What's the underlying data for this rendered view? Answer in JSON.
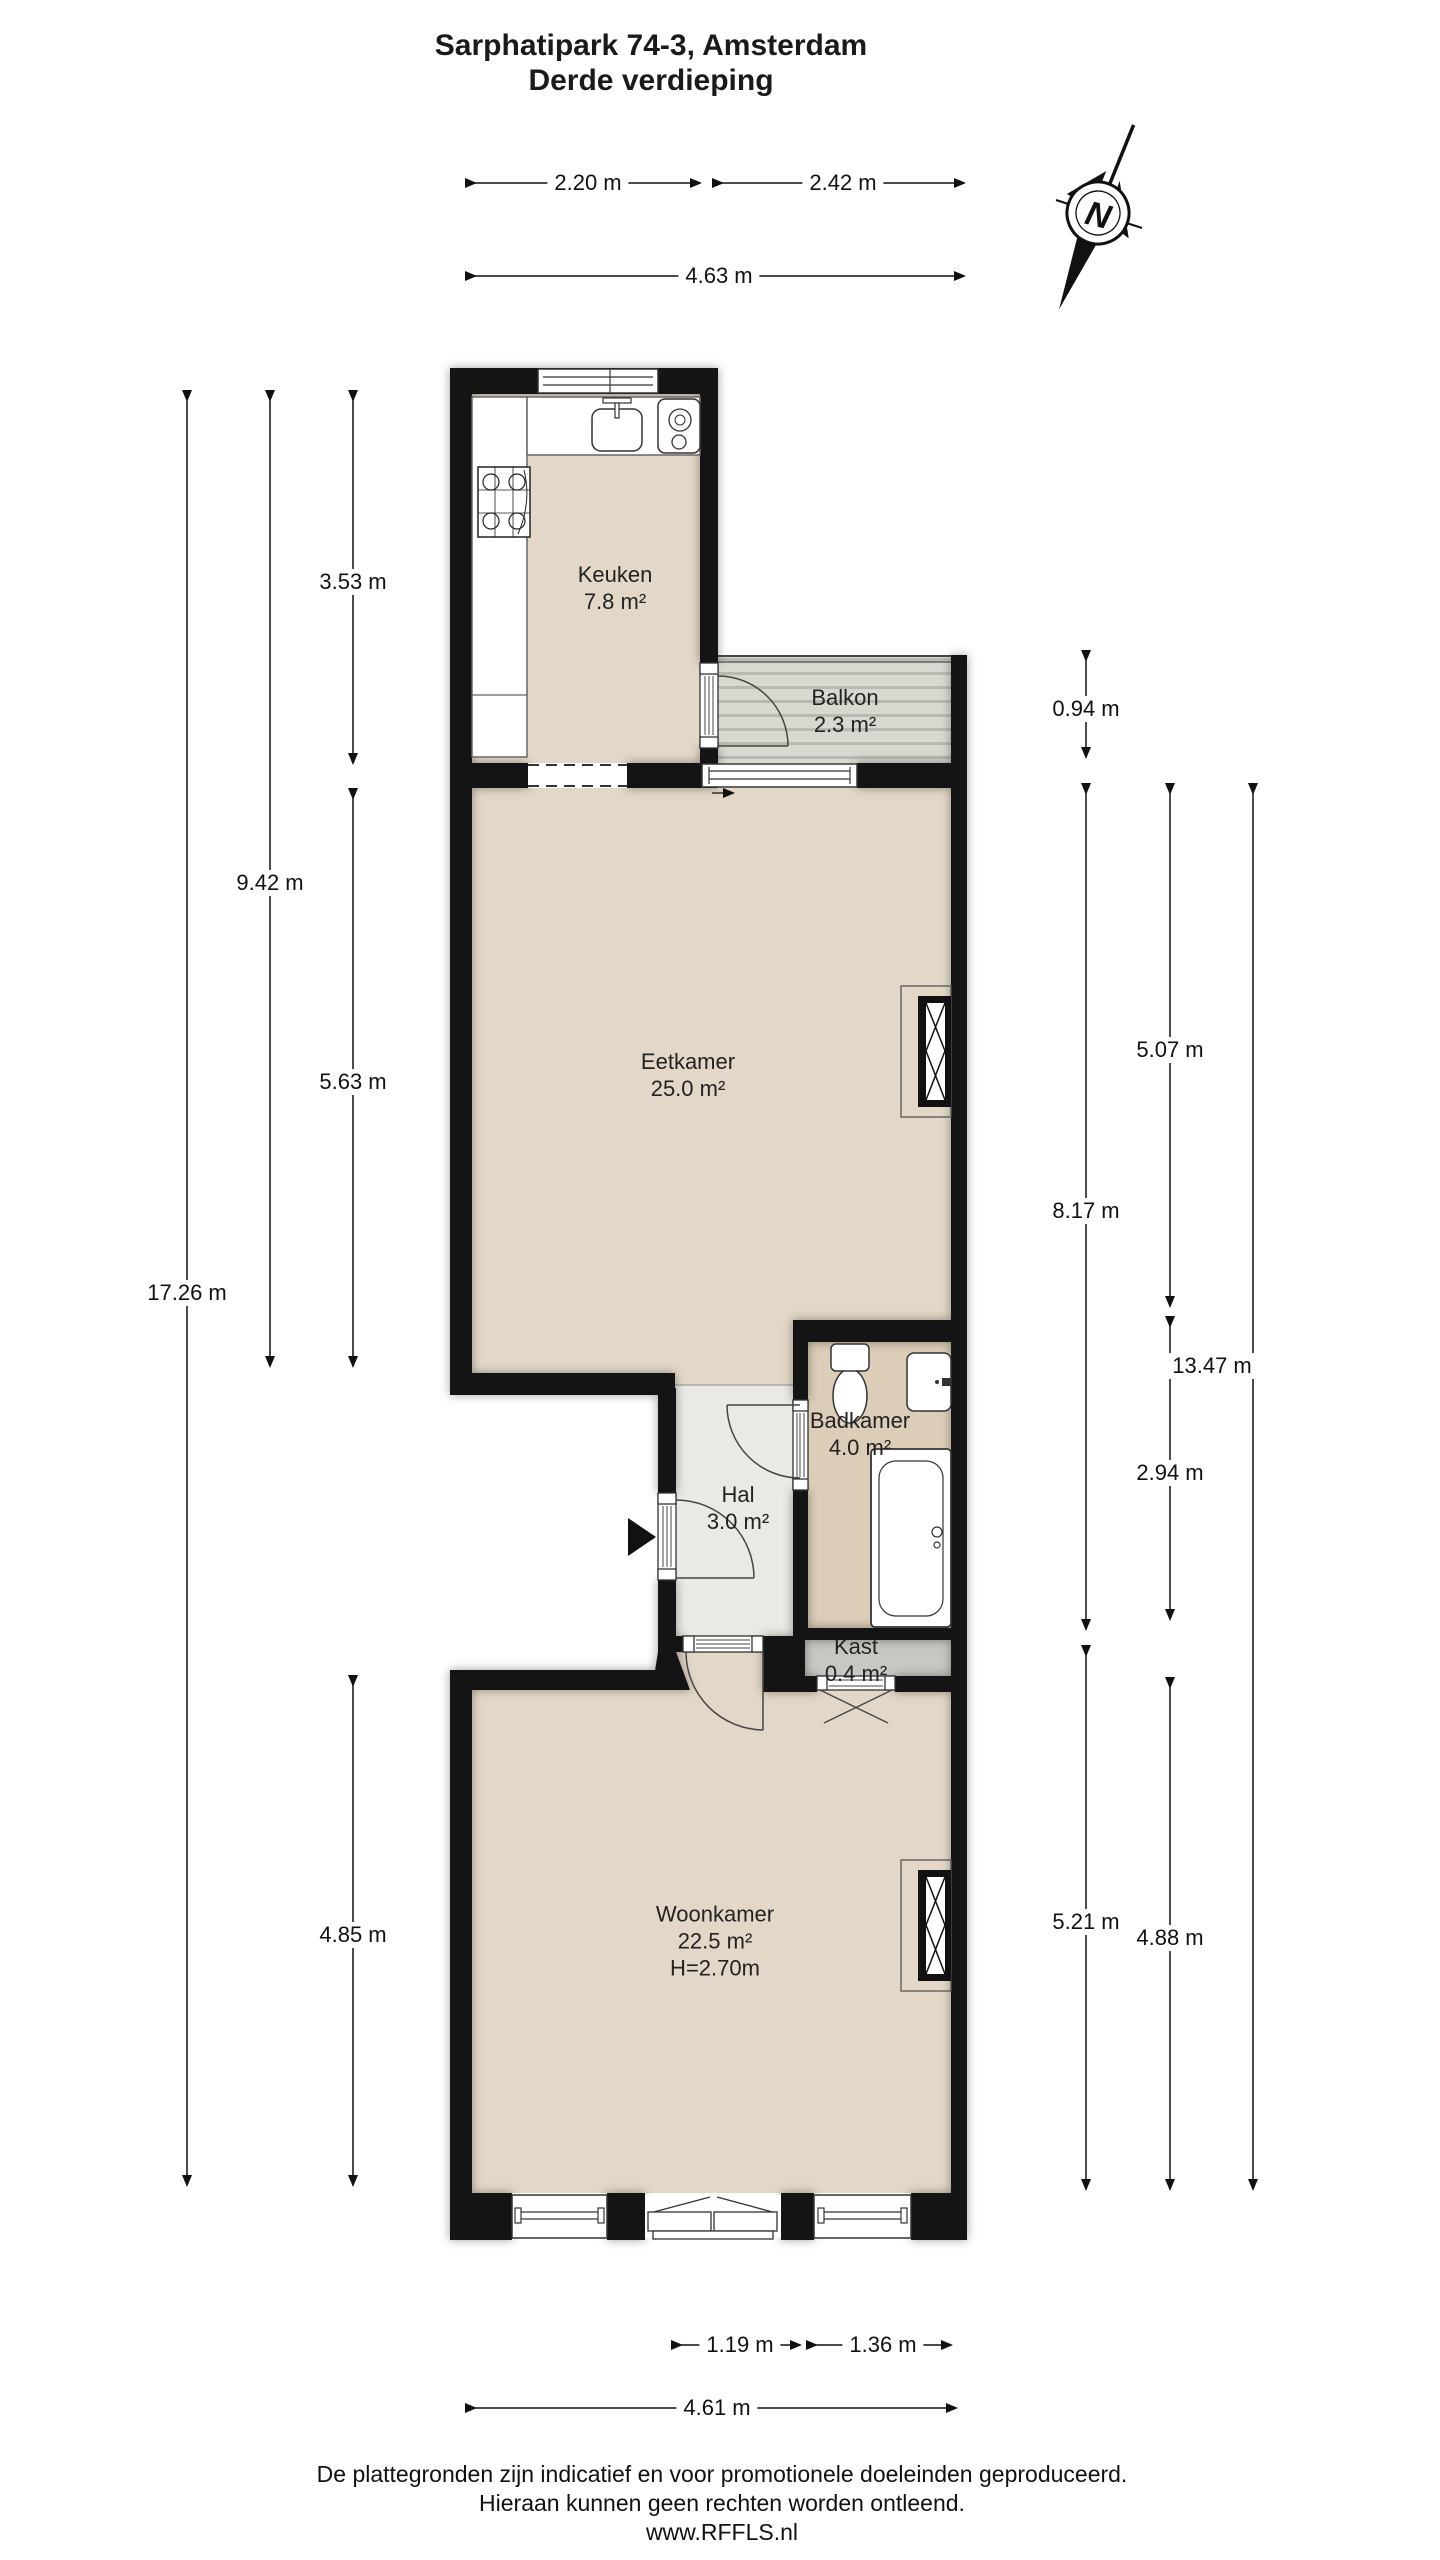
{
  "title": {
    "line1": "Sarphatipark 74-3, Amsterdam",
    "line2": "Derde verdieping"
  },
  "compass": {
    "letter": "N"
  },
  "rooms": {
    "keuken": {
      "name": "Keuken",
      "area": "7.8 m²"
    },
    "balkon": {
      "name": "Balkon",
      "area": "2.3 m²"
    },
    "eetkamer": {
      "name": "Eetkamer",
      "area": "25.0 m²"
    },
    "badkamer": {
      "name": "Badkamer",
      "area": "4.0 m²"
    },
    "hal": {
      "name": "Hal",
      "area": "3.0 m²"
    },
    "kast": {
      "name": "Kast",
      "area": "0.4 m²"
    },
    "woonkamer": {
      "name": "Woonkamer",
      "area": "22.5 m²",
      "ceiling": "H=2.70m"
    }
  },
  "dimensions": {
    "top_left": "2.20 m",
    "top_right": "2.42 m",
    "top_total": "4.63 m",
    "left_keuken": "3.53 m",
    "left_upper": "9.42 m",
    "left_eetkamer": "5.63 m",
    "left_total": "17.26 m",
    "left_woonkamer": "4.85 m",
    "right_balkon": "0.94 m",
    "right_eetkamer": "5.07 m",
    "right_upper": "8.17 m",
    "right_badkamer": "2.94 m",
    "right_total": "13.47 m",
    "right_woonkamer_a": "5.21 m",
    "right_woonkamer_b": "4.88 m",
    "bottom_door": "1.19 m",
    "bottom_window": "1.36 m",
    "bottom_total": "4.61 m"
  },
  "footer": {
    "line1": "De plattegronden zijn indicatief en voor promotionele doeleinden geproduceerd.",
    "line2": "Hieraan kunnen geen rechten worden ontleend.",
    "line3": "www.RFFLS.nl"
  },
  "colors": {
    "wall": "#141414",
    "floor_main": "#e3d8c7",
    "floor_badkamer": "#dccdb8",
    "floor_hal": "#ebe9e3",
    "floor_kast": "#c8c7c1",
    "floor_balkon": "#d8d8d0",
    "balkon_stripe": "#b9b9b1"
  }
}
